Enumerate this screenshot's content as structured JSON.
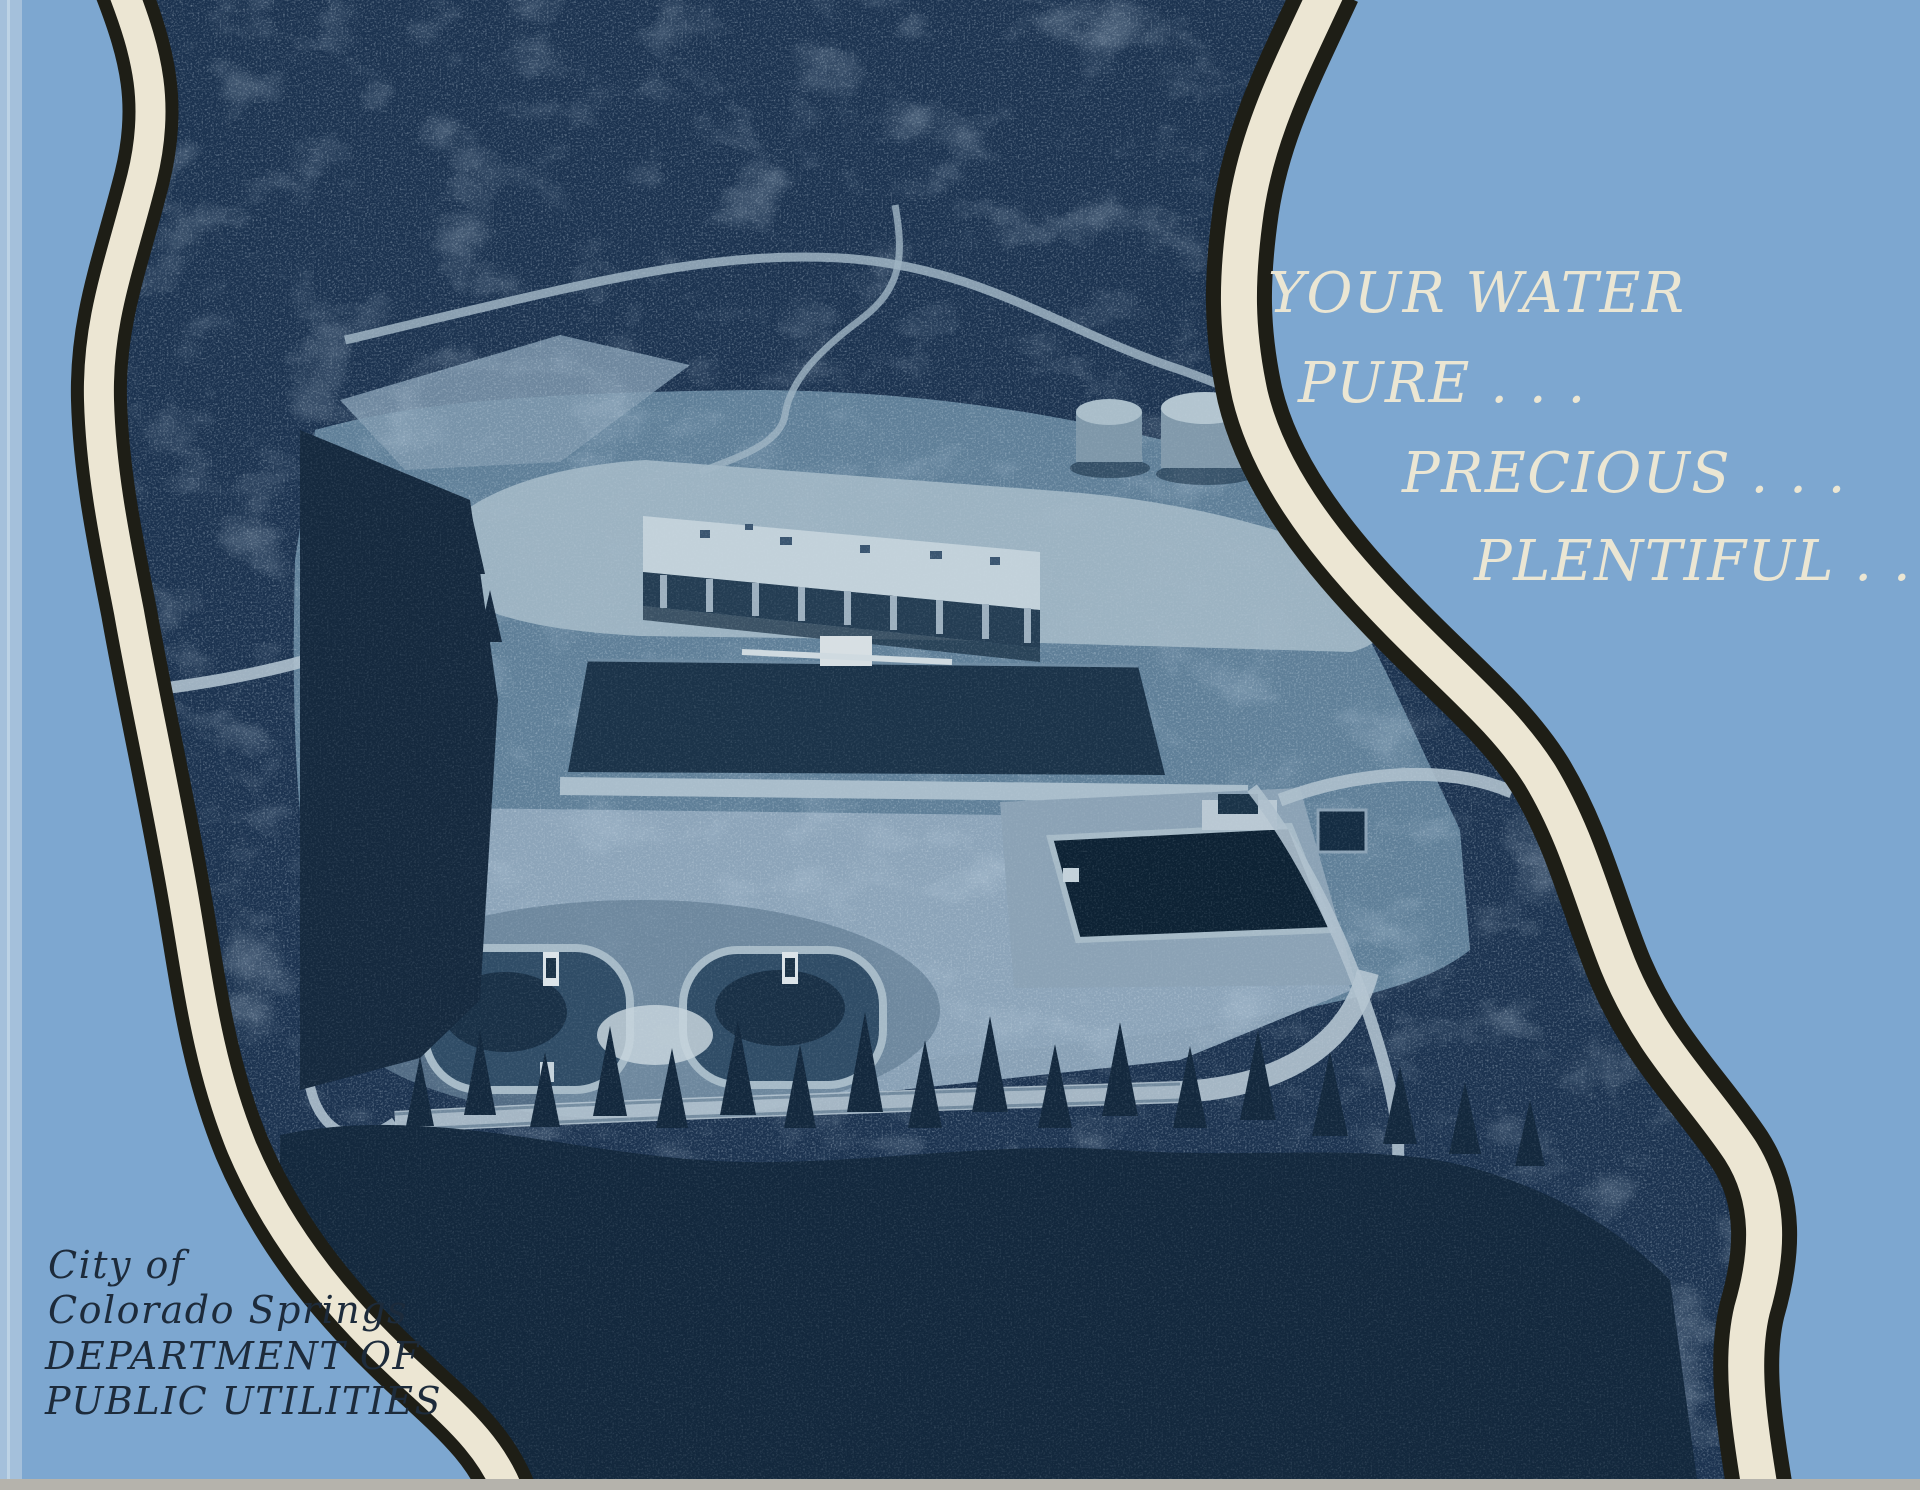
{
  "cover": {
    "photo_alt": "Aerial photograph (blue duotone) of a hillside water treatment plant surrounded by pine forest",
    "tagline": {
      "line1": "YOUR WATER",
      "line2": "PURE . . .",
      "line3": "PRECIOUS . . .",
      "line4": "PLENTIFUL . . ."
    },
    "publisher": {
      "line1": "City of",
      "line2": "Colorado Springs",
      "line3": "DEPARTMENT OF",
      "line4": "PUBLIC UTILITIES"
    },
    "colors": {
      "background_blue": "#7da7d0",
      "spine_blue": "#a4c0db",
      "band_cream": "#ece6d3",
      "band_outline": "#1e1e16",
      "photo_navy_base": "#1c3350",
      "photo_forest_dark": "#142a40",
      "photo_clearing": "#5f7f98",
      "photo_slope": "#8ea7ba",
      "photo_road_light": "#aec0cd",
      "building_roof": "#c2d1da",
      "pool_dark": "#0d2234",
      "tagline_text": "#ebe6d3",
      "publisher_text": "#1d2b3b",
      "bottom_edge_gray": "#b5b3ac"
    }
  }
}
